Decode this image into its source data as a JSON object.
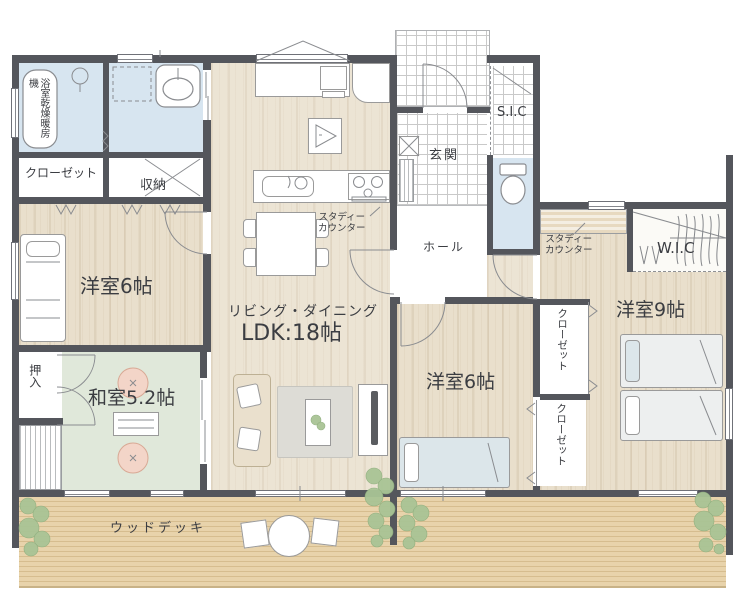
{
  "labels": {
    "bath_unit": "浴室乾燥暖房機",
    "closet_nw": "クローゼット",
    "storage": "収納",
    "bedroom_nw": "洋室6帖",
    "oshiire": "押入",
    "washitsu": "和室5.2帖",
    "ld_line1": "リビング・ダイニング",
    "ld_line2": "LDK:18帖",
    "study_counter_west": "スタディー\nカウンター",
    "genkan": "玄関",
    "hall": "ホール",
    "sic": "S.I.C",
    "study_counter_east": "スタディー\nカウンター",
    "wic": "W.I.C",
    "bedroom_south": "洋室6帖",
    "bedroom_east": "洋室9帖",
    "closet_east_1": "クローゼット",
    "closet_east_2": "クローゼット",
    "deck": "ウッドデッキ"
  },
  "colors": {
    "wall": "#54565c",
    "floor_wood": "#ece4d4",
    "floor_bedroom": "#e9dfcc",
    "tatami": "#e0e8da",
    "water": "#d7e5f0",
    "deck": "#e8d3ab",
    "deck_line": "#d6bd8f",
    "tile_line": "#c9c9c9",
    "hall_floor": "#ffffff",
    "text": "#3b3d42",
    "plant": "#a9c495",
    "plant_dark": "#8fae7e",
    "cushion": "#f3d5c8",
    "furniture_line": "#9a9a9a",
    "rug": "#dddcd6",
    "sofa": "#eae0cd",
    "counter_stripe": "#e7d9c0",
    "bed_duvet": "#edefef",
    "bed_blue": "#dce6ea"
  }
}
